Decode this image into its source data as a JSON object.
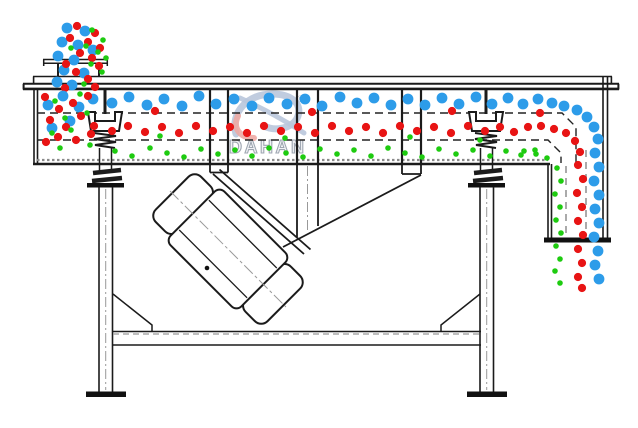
{
  "watermark": {
    "brand": "DAHAN",
    "registered": "®",
    "logo_blue": "#b9c7db",
    "logo_red": "#edaaa4",
    "text_fill": "#f1f2f5",
    "text_stroke": "#9aa3ae",
    "registered_color": "#b9c2cf"
  },
  "line_color": "#1b1b1b",
  "particles": {
    "styles": {
      "blue": {
        "hex": "#2d9ce9",
        "radius": 5.4
      },
      "red": {
        "hex": "#e81414",
        "radius": 4.1
      },
      "green": {
        "hex": "#1ecb10",
        "radius": 2.8
      }
    },
    "groups": [
      {
        "name": "feed-stream-blue",
        "color": "blue",
        "points": [
          [
            67,
            28
          ],
          [
            85,
            31
          ],
          [
            62,
            42
          ],
          [
            78,
            45
          ],
          [
            93,
            50
          ],
          [
            58,
            56
          ],
          [
            74,
            60
          ],
          [
            64,
            70
          ],
          [
            84,
            73
          ],
          [
            57,
            82
          ],
          [
            72,
            85
          ]
        ]
      },
      {
        "name": "feed-stream-red",
        "color": "red",
        "points": [
          [
            77,
            26
          ],
          [
            95,
            33
          ],
          [
            70,
            38
          ],
          [
            88,
            42
          ],
          [
            100,
            48
          ],
          [
            80,
            53
          ],
          [
            92,
            58
          ],
          [
            66,
            64
          ],
          [
            99,
            66
          ],
          [
            76,
            72
          ],
          [
            88,
            79
          ],
          [
            65,
            88
          ],
          [
            95,
            87
          ]
        ]
      },
      {
        "name": "feed-stream-green",
        "color": "green",
        "points": [
          [
            92,
            30
          ],
          [
            103,
            40
          ],
          [
            86,
            46
          ],
          [
            98,
            52
          ],
          [
            106,
            58
          ],
          [
            91,
            64
          ],
          [
            102,
            72
          ],
          [
            84,
            84
          ],
          [
            71,
            48
          ]
        ]
      },
      {
        "name": "top-deck-blue",
        "color": "blue",
        "points": [
          [
            48,
            105
          ],
          [
            63,
            96
          ],
          [
            79,
            107
          ],
          [
            93,
            99
          ],
          [
            70,
            121
          ],
          [
            52,
            128
          ],
          [
            112,
            103
          ],
          [
            129,
            97
          ],
          [
            147,
            105
          ],
          [
            164,
            99
          ],
          [
            182,
            106
          ],
          [
            199,
            96
          ],
          [
            216,
            104
          ],
          [
            234,
            99
          ],
          [
            252,
            106
          ],
          [
            269,
            98
          ],
          [
            287,
            104
          ],
          [
            305,
            99
          ],
          [
            322,
            106
          ],
          [
            340,
            97
          ],
          [
            357,
            103
          ],
          [
            374,
            98
          ],
          [
            391,
            105
          ],
          [
            408,
            99
          ],
          [
            425,
            105
          ],
          [
            442,
            98
          ],
          [
            459,
            104
          ],
          [
            476,
            97
          ],
          [
            492,
            104
          ],
          [
            508,
            98
          ],
          [
            523,
            104
          ],
          [
            538,
            99
          ]
        ]
      },
      {
        "name": "middle-deck-red",
        "color": "red",
        "points": [
          [
            45,
            97
          ],
          [
            59,
            109
          ],
          [
            73,
            103
          ],
          [
            88,
            96
          ],
          [
            50,
            120
          ],
          [
            66,
            127
          ],
          [
            81,
            116
          ],
          [
            94,
            126
          ],
          [
            58,
            137
          ],
          [
            76,
            140
          ],
          [
            91,
            134
          ],
          [
            46,
            142
          ],
          [
            112,
            131
          ],
          [
            128,
            126
          ],
          [
            145,
            132
          ],
          [
            162,
            127
          ],
          [
            179,
            133
          ],
          [
            196,
            126
          ],
          [
            213,
            131
          ],
          [
            230,
            127
          ],
          [
            247,
            133
          ],
          [
            264,
            126
          ],
          [
            281,
            131
          ],
          [
            298,
            127
          ],
          [
            315,
            133
          ],
          [
            332,
            126
          ],
          [
            349,
            131
          ],
          [
            366,
            127
          ],
          [
            383,
            133
          ],
          [
            400,
            126
          ],
          [
            417,
            131
          ],
          [
            434,
            127
          ],
          [
            451,
            133
          ],
          [
            468,
            126
          ],
          [
            485,
            131
          ],
          [
            500,
            127
          ],
          [
            514,
            132
          ],
          [
            528,
            127
          ],
          [
            155,
            111
          ],
          [
            312,
            112
          ],
          [
            452,
            111
          ],
          [
            540,
            113
          ]
        ]
      },
      {
        "name": "bottom-deck-green",
        "color": "green",
        "points": [
          [
            55,
            101
          ],
          [
            80,
            94
          ],
          [
            65,
            118
          ],
          [
            87,
            113
          ],
          [
            52,
            133
          ],
          [
            71,
            130
          ],
          [
            90,
            145
          ],
          [
            60,
            148
          ],
          [
            115,
            151
          ],
          [
            132,
            156
          ],
          [
            150,
            148
          ],
          [
            167,
            153
          ],
          [
            184,
            157
          ],
          [
            201,
            149
          ],
          [
            218,
            154
          ],
          [
            235,
            150
          ],
          [
            252,
            156
          ],
          [
            269,
            148
          ],
          [
            286,
            153
          ],
          [
            303,
            157
          ],
          [
            320,
            149
          ],
          [
            337,
            154
          ],
          [
            354,
            150
          ],
          [
            371,
            156
          ],
          [
            388,
            148
          ],
          [
            405,
            153
          ],
          [
            422,
            157
          ],
          [
            439,
            149
          ],
          [
            456,
            154
          ],
          [
            473,
            150
          ],
          [
            490,
            156
          ],
          [
            506,
            151
          ],
          [
            521,
            155
          ],
          [
            535,
            150
          ],
          [
            160,
            136
          ],
          [
            285,
            138
          ],
          [
            410,
            137
          ],
          [
            480,
            140
          ]
        ]
      },
      {
        "name": "discharge-blue",
        "color": "blue",
        "points": [
          [
            552,
            103
          ],
          [
            564,
            106
          ],
          [
            577,
            110
          ],
          [
            587,
            117
          ],
          [
            594,
            127
          ],
          [
            598,
            139
          ],
          [
            595,
            153
          ],
          [
            599,
            167
          ],
          [
            594,
            181
          ],
          [
            599,
            195
          ],
          [
            595,
            209
          ],
          [
            599,
            223
          ],
          [
            594,
            237
          ],
          [
            598,
            251
          ],
          [
            595,
            265
          ],
          [
            599,
            279
          ]
        ]
      },
      {
        "name": "discharge-red",
        "color": "red",
        "points": [
          [
            541,
            126
          ],
          [
            554,
            129
          ],
          [
            566,
            133
          ],
          [
            575,
            141
          ],
          [
            580,
            152
          ],
          [
            578,
            165
          ],
          [
            583,
            179
          ],
          [
            577,
            193
          ],
          [
            582,
            207
          ],
          [
            578,
            221
          ],
          [
            583,
            235
          ],
          [
            578,
            249
          ],
          [
            582,
            263
          ],
          [
            578,
            277
          ],
          [
            582,
            288
          ]
        ]
      },
      {
        "name": "discharge-green",
        "color": "green",
        "points": [
          [
            524,
            151
          ],
          [
            536,
            154
          ],
          [
            547,
            158
          ],
          [
            557,
            168
          ],
          [
            561,
            181
          ],
          [
            555,
            194
          ],
          [
            560,
            207
          ],
          [
            556,
            220
          ],
          [
            561,
            233
          ],
          [
            556,
            246
          ],
          [
            560,
            259
          ],
          [
            555,
            271
          ],
          [
            560,
            283
          ]
        ]
      }
    ]
  }
}
